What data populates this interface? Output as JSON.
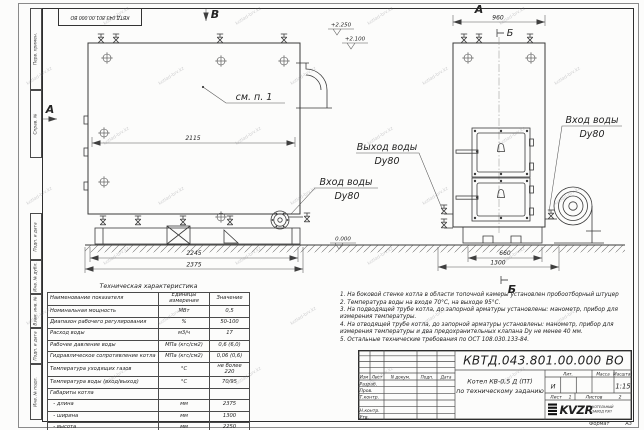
{
  "watermark": {
    "text": "kotlad-brv.kz"
  },
  "frame": {
    "stamp_top": "КВТД.043.801.00.000 ВО",
    "left_labels": [
      "Перв. примен.",
      "Справ. №",
      "Подп. и дата",
      "Инв. № дубл.",
      "Взам. инв. №",
      "Подп. и дата",
      "Инв. № подл."
    ],
    "format_label": "Формат",
    "format_value": "А3"
  },
  "front_view": {
    "view_label_top": "В",
    "view_label_left": "А",
    "callout": "см. п. 1",
    "dim_inner": "2115",
    "dim_base": "2245",
    "dim_overall": "2375",
    "elev_top": "+2.250",
    "elev_pipe": "+2.100",
    "elev_zero": "0.000",
    "inlet": {
      "line1": "Вход воды",
      "line2": "Dy80"
    },
    "outlet": {
      "line1": "Выход воды",
      "line2": "Dy80"
    }
  },
  "side_view": {
    "view_label_top": "А",
    "dim_top": "960",
    "section_mark": "Б",
    "dim_base": "660",
    "dim_overall": "1300",
    "inlet": {
      "line1": "Вход воды",
      "line2": "Dy80"
    }
  },
  "notes": [
    "1. На боковой стенке котла в области топочной камеры установлен пробоотборный штуцер",
    "2. Температура воды на входе 70°С, на выходе 95°С.",
    "3. На подводящей трубе котла, до запорной арматуры установлены: манометр, прибор для измерения температуры.",
    "4. На отводящей трубе котла, до запорной арматуры установлены: манометр, прибор для измерения температуры и два предохранительных клапана Dy не менее 40 мм.",
    "5. Остальные технические требования по ОСТ 108.030.133-84."
  ],
  "tech_table": {
    "title": "Техническая характеристика",
    "headers": [
      "Наименование показателя",
      "Единицы измерения",
      "Значение"
    ],
    "rows": [
      [
        "Номинальная мощность",
        "МВт",
        "0,5"
      ],
      [
        "Диапазон рабочего регулирования",
        "%",
        "50-100"
      ],
      [
        "Расход воды",
        "м3/ч",
        "17"
      ],
      [
        "Рабочее давление воды",
        "МПа (кгс/см2)",
        "0,6 (6,0)"
      ],
      [
        "Гидравлическое сопротивление котла",
        "МПа (кгс/см2)",
        "0,06 (0,6)"
      ],
      [
        "Температура уходящих газов",
        "°С",
        "не более 220"
      ],
      [
        "Температура воды (вход/выход)",
        "°С",
        "70/95"
      ],
      [
        "Габариты котла",
        "",
        ""
      ],
      [
        "  - длина",
        "мм",
        "2375"
      ],
      [
        "  - ширина",
        "мм",
        "1300"
      ],
      [
        "  - высота",
        "мм",
        "2250"
      ]
    ]
  },
  "title_block": {
    "doc_number": "КВТД.043.801.00.000 ВО",
    "rev_headers": [
      "Изм",
      "Лист",
      "N докум.",
      "Подп.",
      "Дата"
    ],
    "sign_rows": [
      "Разраб.",
      "Пров.",
      "Т.контр.",
      "",
      "Н.контр.",
      "Утв."
    ],
    "product_line1": "Котел КВ-0,5 Д (ПТ)",
    "product_line2": "по техническому заданию",
    "lit_header": "Лит.",
    "lit_value": "И",
    "mass_header": "Масса",
    "scale_header": "Масштаб",
    "scale_value": "1:15",
    "sheet_label": "Лист",
    "sheet_value": "1",
    "sheets_label": "Листов",
    "sheets_value": "2",
    "logo_text": "KVZR",
    "logo_sub1": "КОТЕЛЬНЫЙ",
    "logo_sub2": "ЗАВОД РЭП"
  }
}
